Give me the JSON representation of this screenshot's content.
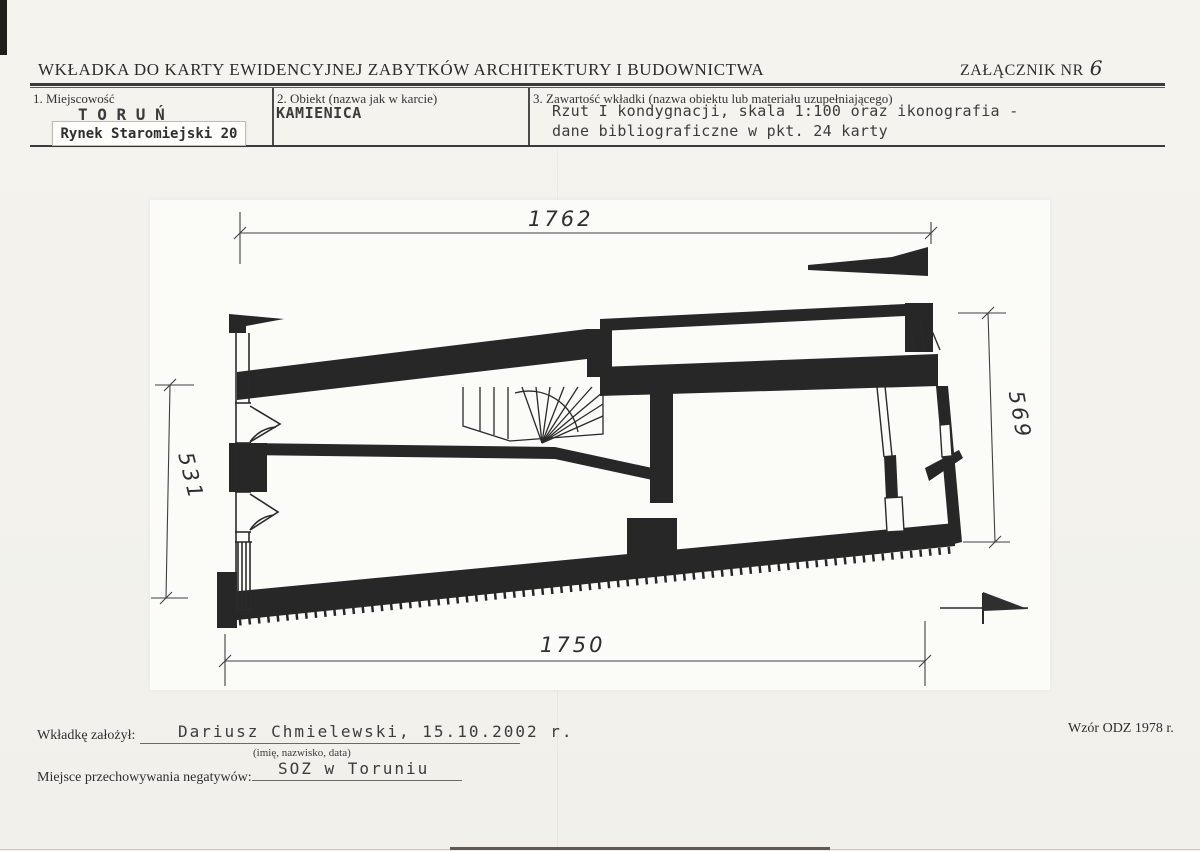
{
  "header": {
    "title": "WKŁADKA DO KARTY EWIDENCYJNEJ ZABYTKÓW ARCHITEKTURY I BUDOWNICTWA",
    "attachment": {
      "label": "ZAŁĄCZNIK NR",
      "number": "6"
    }
  },
  "form": {
    "locality": {
      "label": "1. Miejscowość",
      "city": "T O R U Ń",
      "address": "Rynek Staromiejski 20"
    },
    "object": {
      "label": "2. Obiekt (nazwa jak w karcie)",
      "value": "KAMIENICA"
    },
    "contents": {
      "label": "3. Zawartość wkładki (nazwa obiektu lub materiału uzupełniającego)",
      "line1": "Rzut I kondygnacji, skala 1:100 oraz ikonografia -",
      "line2": "dane bibliograficzne w pkt. 24 karty"
    }
  },
  "drawing": {
    "kind": "floor-plan",
    "dimensions": {
      "top": "1762",
      "left": "531",
      "right": "569",
      "bottom": "1750"
    }
  },
  "footer": {
    "author": {
      "label": "Wkładkę założył:",
      "value": "Dariusz Chmielewski, 15.10.2002 r.",
      "hint": "(imię, nazwisko, data)"
    },
    "negatives": {
      "label": "Miejsce przechowywania negatywów:",
      "value": "SOZ w Toruniu"
    },
    "template_note": "Wzór ODZ 1978 r."
  }
}
